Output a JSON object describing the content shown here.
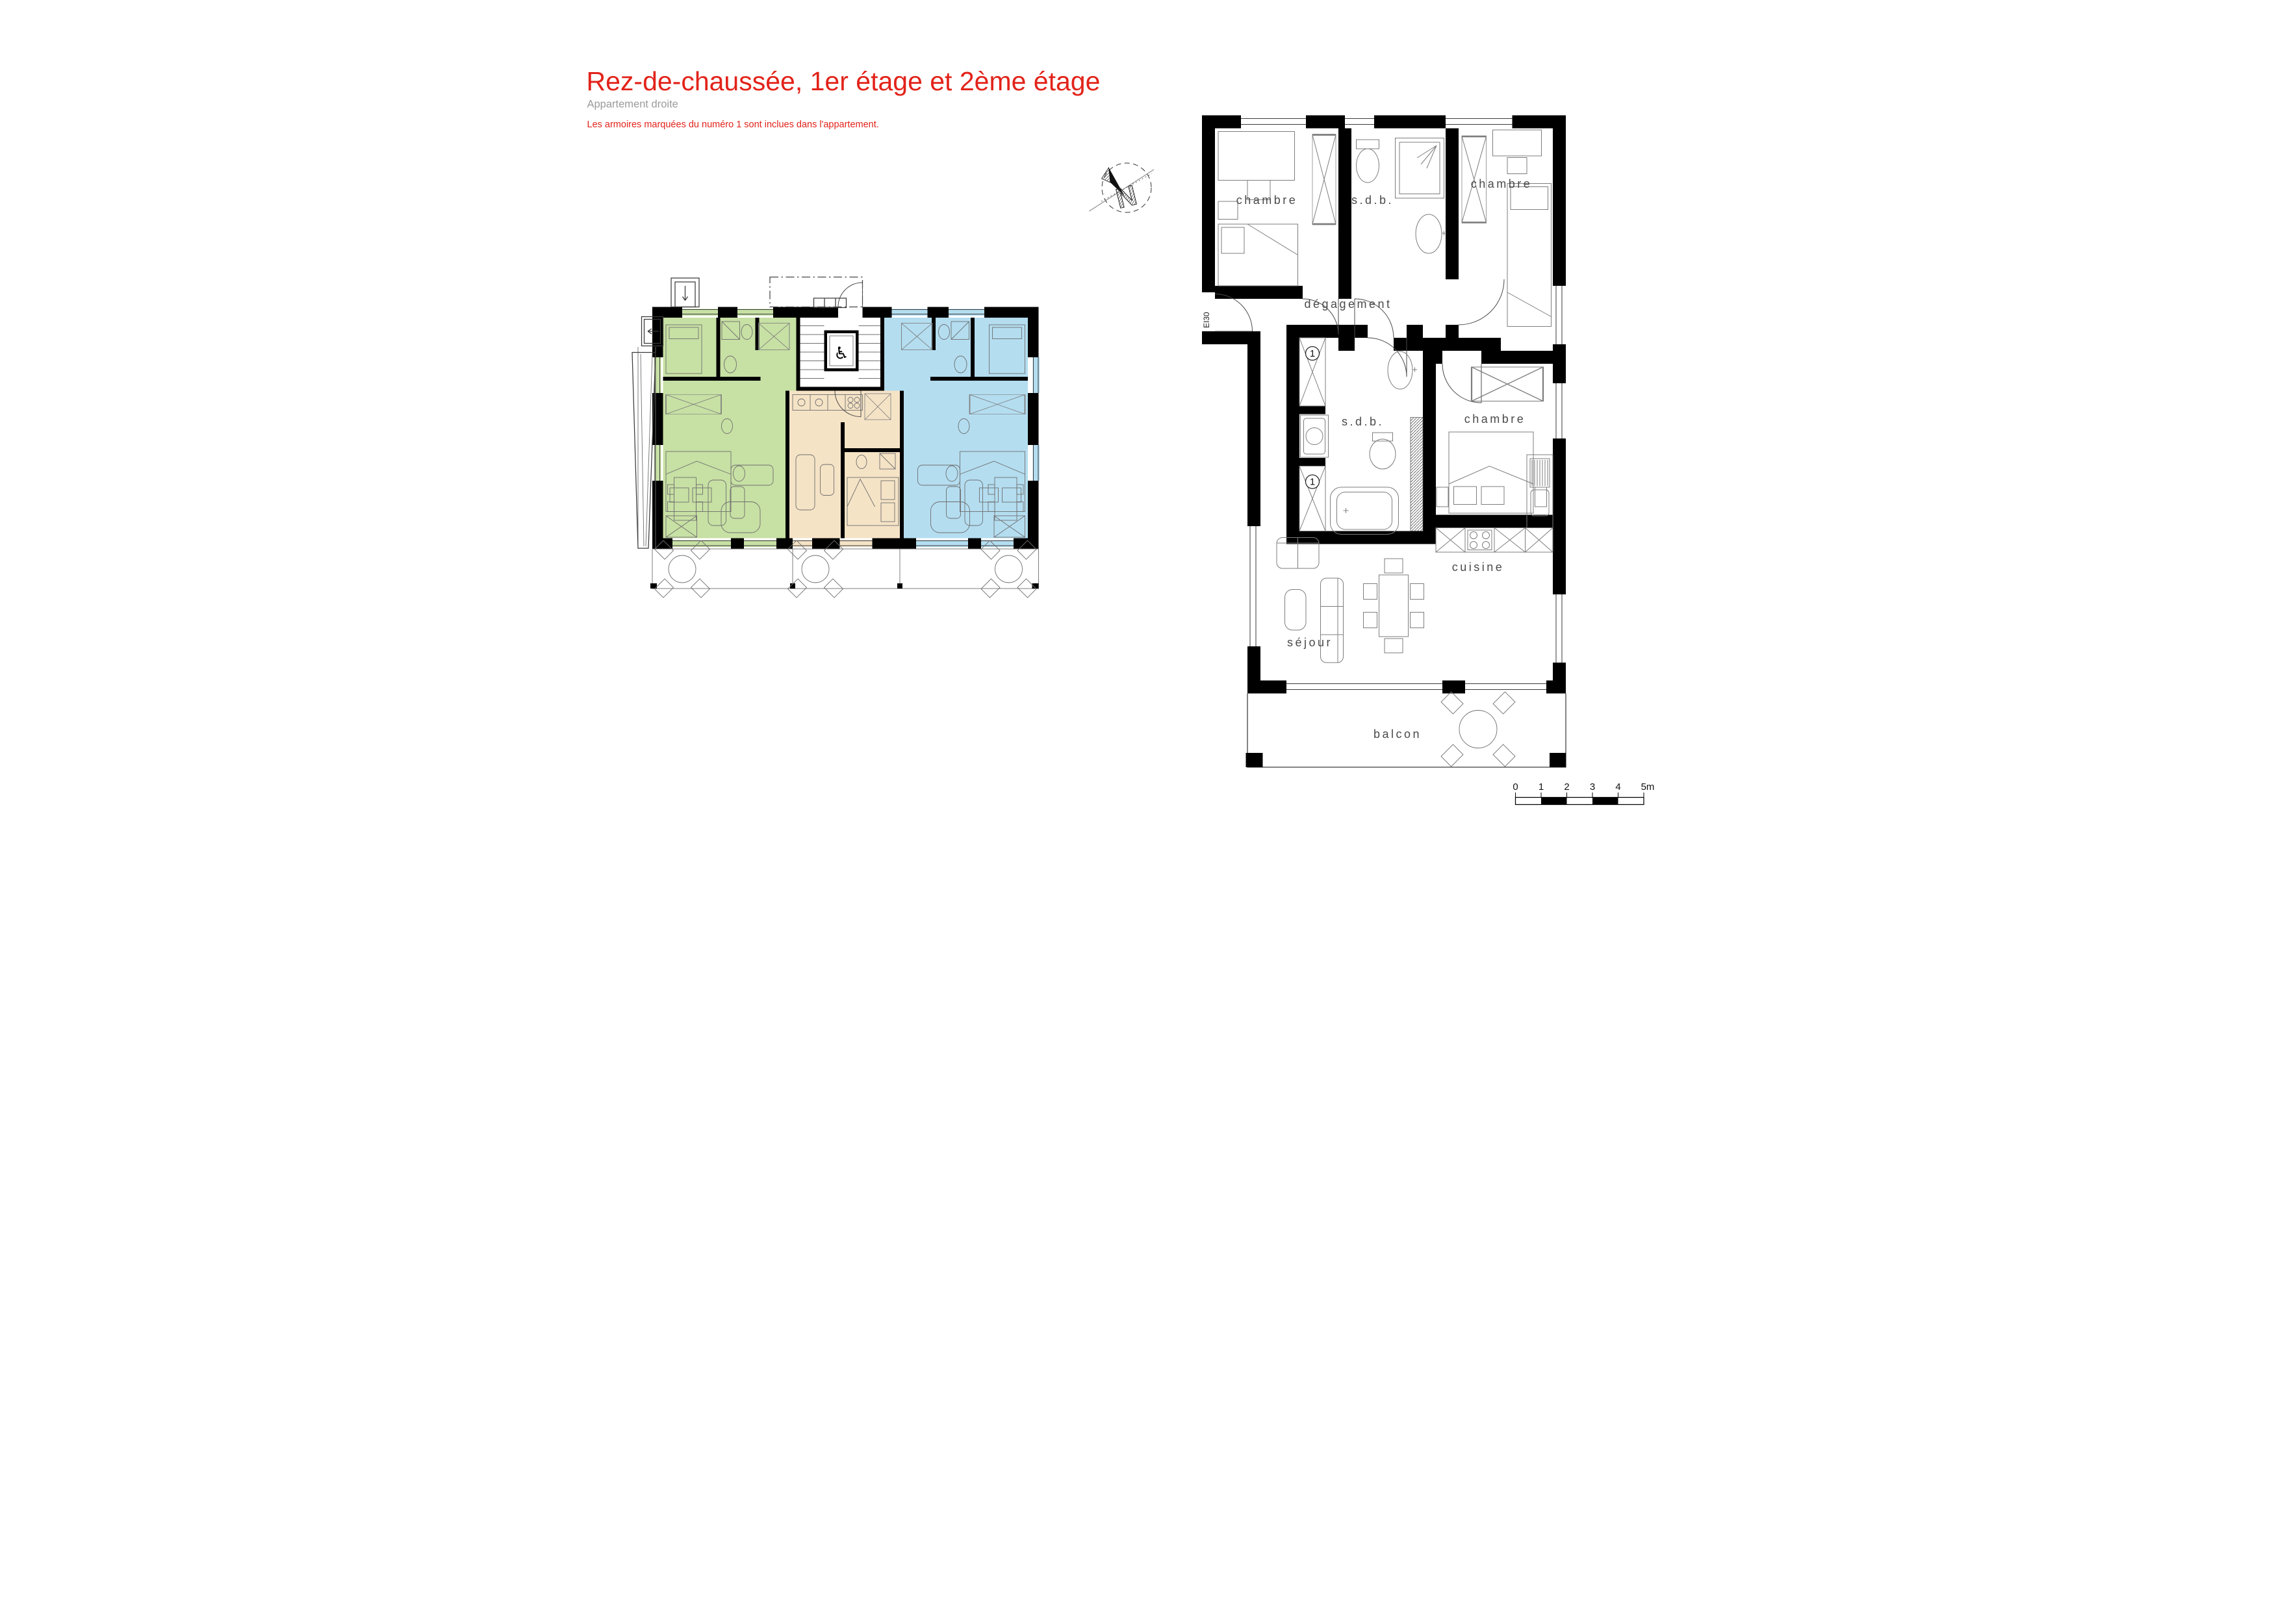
{
  "header": {
    "title": "Rez-de-chaussée, 1er étage et 2ème étage",
    "subtitle": "Appartement droite",
    "note": "Les armoires marquées du numéro 1 sont inclues dans l'appartement."
  },
  "colors": {
    "title_red": "#e2231a",
    "note_red": "#e2231a",
    "subtitle_gray": "#9b9b9b",
    "apartment_green": "#c7e0a4",
    "apartment_beige": "#f5e3c6",
    "apartment_blue": "#b4ddf0",
    "wall_black": "#000000",
    "label_gray": "#4a4a4a"
  },
  "compass": {
    "label": "N"
  },
  "detail_plan": {
    "rooms": [
      {
        "label": "chambre"
      },
      {
        "label": "s.d.b."
      },
      {
        "label": "chambre"
      },
      {
        "label": "dégagement"
      },
      {
        "label": "s.d.b."
      },
      {
        "label": "chambre"
      },
      {
        "label": "cuisine"
      },
      {
        "label": "séjour"
      },
      {
        "label": "balcon"
      }
    ],
    "door_rating_label": "EI30",
    "included_wardrobe_marker": "1"
  },
  "scale_bar": {
    "ticks": [
      "0",
      "1",
      "2",
      "3",
      "4"
    ],
    "end_label": "5m"
  }
}
